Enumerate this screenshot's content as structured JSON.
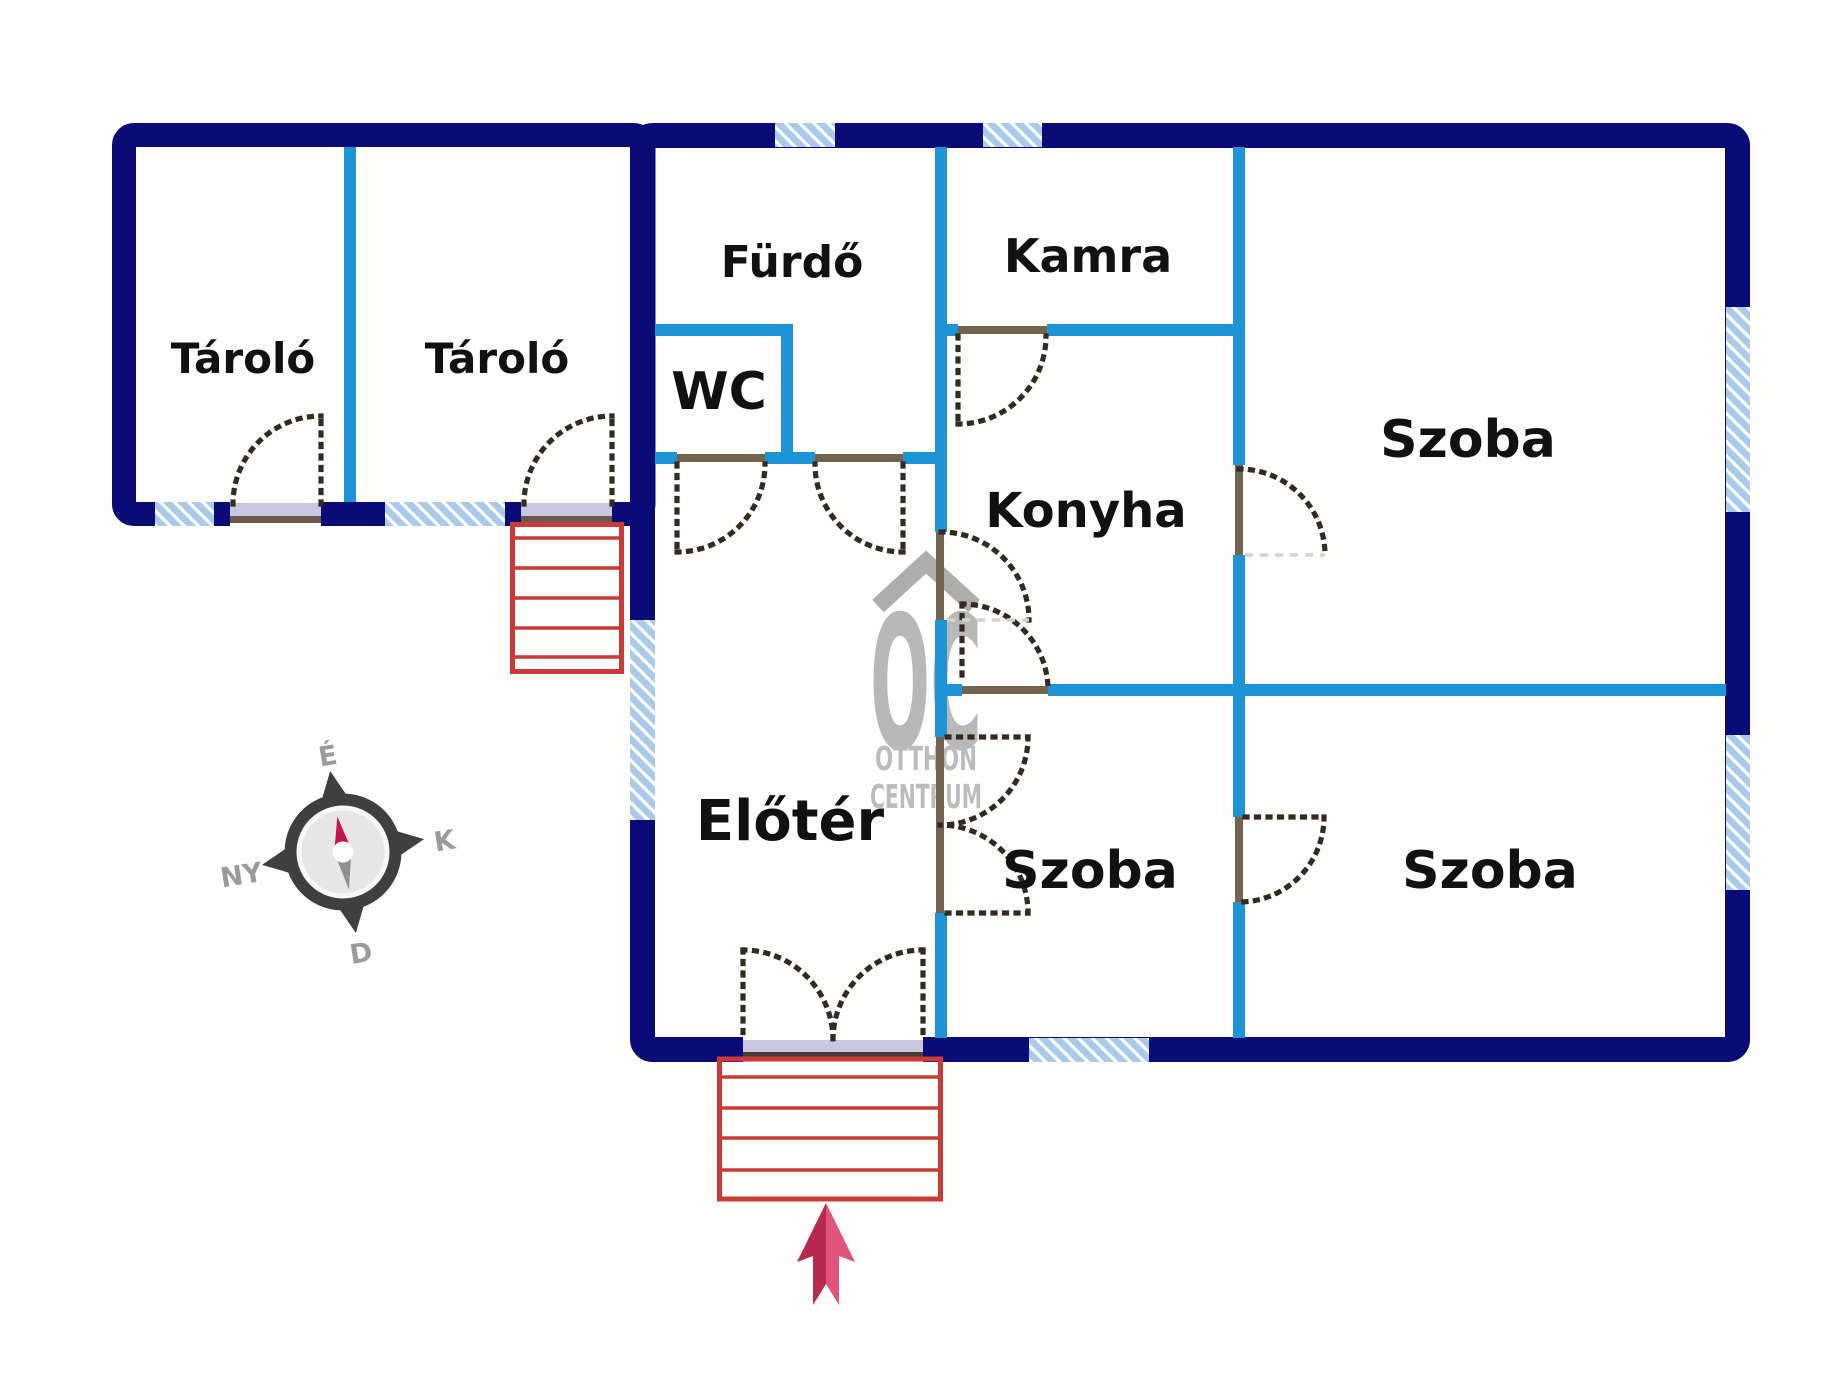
{
  "rooms": {
    "tarolo1": {
      "label": "Tároló"
    },
    "tarolo2": {
      "label": "Tároló"
    },
    "furdo": {
      "label": "Fürdő"
    },
    "wc": {
      "label": "WC"
    },
    "kamra": {
      "label": "Kamra"
    },
    "konyha": {
      "label": "Konyha"
    },
    "szoba_top_right": {
      "label": "Szoba"
    },
    "eloter": {
      "label": "Előtér"
    },
    "szoba_bottom_middle": {
      "label": "Szoba"
    },
    "szoba_bottom_right": {
      "label": "Szoba"
    }
  },
  "compass": {
    "north": "É",
    "east": "K",
    "south": "D",
    "west": "NY"
  },
  "watermark": {
    "monogram": "OC",
    "line1": "OTTHON",
    "line2": "CENTRUM"
  },
  "colors": {
    "outer_wall": "#0b0b77",
    "partition": "#1e93d6",
    "window_fill": "#a9cbe9",
    "stairs": "#c93a38",
    "entrance_arrow_dark": "#b8294e",
    "entrance_arrow_light": "#e0537a",
    "door_swing": "#342a20",
    "door_sill": "#74634f",
    "threshold": "#c7c7e0",
    "compass_body": "#3f3f41",
    "compass_needle_north": "#c41647",
    "compass_needle_south": "#8e8e90",
    "watermark_gray": "#a2a2a2"
  }
}
